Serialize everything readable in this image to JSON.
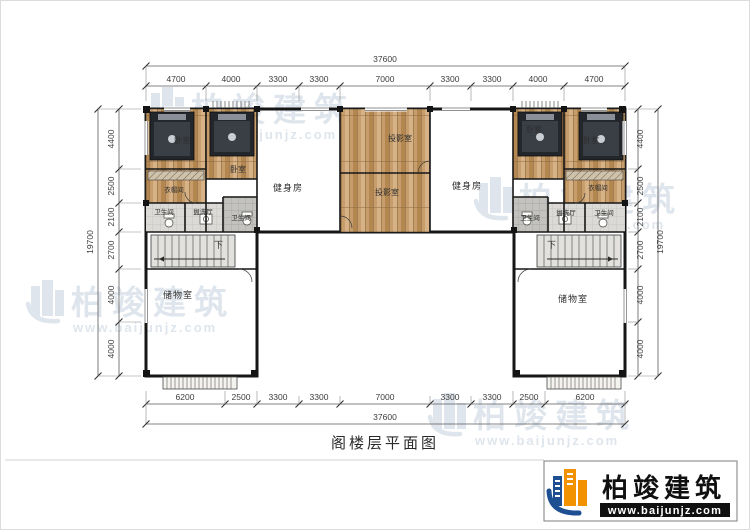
{
  "title": "阁楼层平面图",
  "brand": {
    "name": "柏竣建筑",
    "url": "www.baijunjz.com"
  },
  "watermark": {
    "name": "柏竣建筑",
    "url": "www.baijunjz.com"
  },
  "rooms": {
    "bedroom": "卧室",
    "cloakroom": "衣帽间",
    "bathroom": "卫生间",
    "washroom": "盥洗厅",
    "gym": "健身房",
    "projection": "投影室",
    "storage": "储物室",
    "stairs_down": "下"
  },
  "dims": {
    "top": {
      "total": "37600",
      "segments": [
        "4700",
        "4000",
        "3300",
        "3300",
        "7000",
        "3300",
        "3300",
        "4000",
        "4700"
      ]
    },
    "bottom": {
      "total": "37600",
      "segments": [
        "6200",
        "2500",
        "3300",
        "3300",
        "7000",
        "3300",
        "3300",
        "2500",
        "6200"
      ]
    },
    "left": {
      "total": "19700",
      "segments": [
        "4400",
        "2500",
        "2100",
        "2700",
        "4000",
        "4000"
      ]
    },
    "right": {
      "total": "19700",
      "segments": [
        "4400",
        "2500",
        "2100",
        "2700",
        "4000",
        "4000"
      ]
    }
  }
}
